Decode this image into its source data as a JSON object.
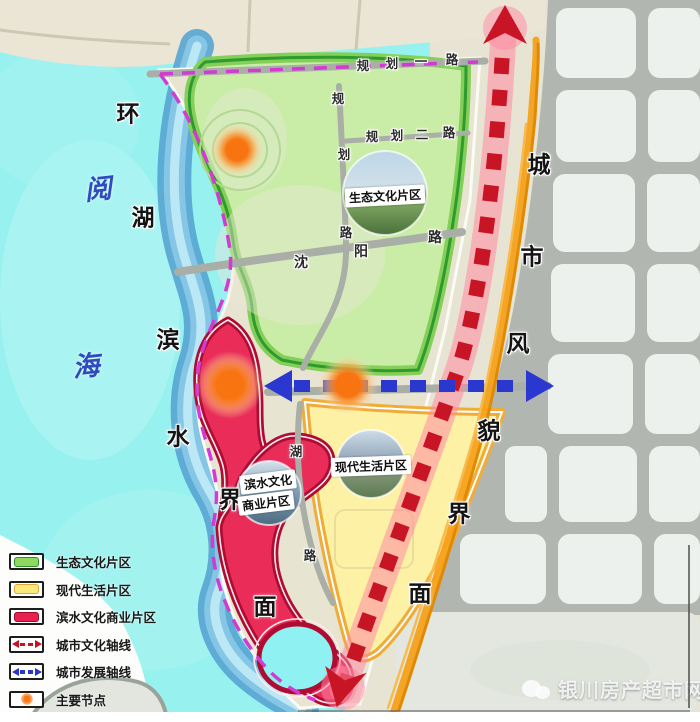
{
  "title": "滨水片区规划结构图",
  "legend": {
    "items": [
      {
        "label": "生态文化片区",
        "type": "zone",
        "fill": "#8ed95e",
        "stroke": "#2f8f2f"
      },
      {
        "label": "现代生活片区",
        "type": "zone",
        "fill": "#fbe87d",
        "stroke": "#e2a43c"
      },
      {
        "label": "滨水文化商业片区",
        "type": "zone",
        "fill": "#e8214e",
        "stroke": "#9c0c2c"
      },
      {
        "label": "城市文化轴线",
        "type": "axis",
        "icon": "double-arrow-dashed",
        "color": "#c41322"
      },
      {
        "label": "城市发展轴线",
        "type": "axis",
        "icon": "double-arrow-dashed",
        "color": "#2b36c8"
      },
      {
        "label": "主要节点",
        "type": "node",
        "color": "#f87716"
      }
    ]
  },
  "map": {
    "zones": [
      {
        "name": "生态文化片区",
        "color": "#c8eda4"
      },
      {
        "name": "现代生活片区",
        "color": "#fdf1a6"
      },
      {
        "name": "滨水文化商业片区",
        "line1": "滨水文化",
        "line2": "商业片区",
        "color": "#e92850"
      }
    ],
    "west_interface": {
      "label": "环湖滨水界面",
      "chars": [
        "环",
        "湖",
        "滨",
        "水",
        "界",
        "面"
      ]
    },
    "east_interface": {
      "label": "城市风貌界面",
      "chars": [
        "城",
        "市",
        "风",
        "貌",
        "界",
        "面"
      ]
    },
    "lake": {
      "name": "阅海",
      "chars": [
        "阅",
        "海"
      ]
    },
    "roads": {
      "guihua1": {
        "name": "规划一路",
        "chars": [
          "规",
          "划",
          "一",
          "路"
        ]
      },
      "guihua2": {
        "name": "规划二路",
        "chars": [
          "规",
          "划",
          "二",
          "路"
        ]
      },
      "shenyang": {
        "name": "沈阳路",
        "chars": [
          "沈",
          "阳",
          "路"
        ]
      },
      "vertical": {
        "name": "规划路",
        "chars": [
          "规",
          "划",
          "路"
        ]
      },
      "hu": {
        "name": "湖路",
        "chars": [
          "湖",
          "路"
        ]
      }
    },
    "axes": [
      {
        "name": "城市文化轴线",
        "color": "#c41322"
      },
      {
        "name": "城市发展轴线",
        "color": "#2b36c8"
      }
    ],
    "nodes_label": "主要节点"
  },
  "watermark": {
    "text": "银川房产超市网"
  }
}
